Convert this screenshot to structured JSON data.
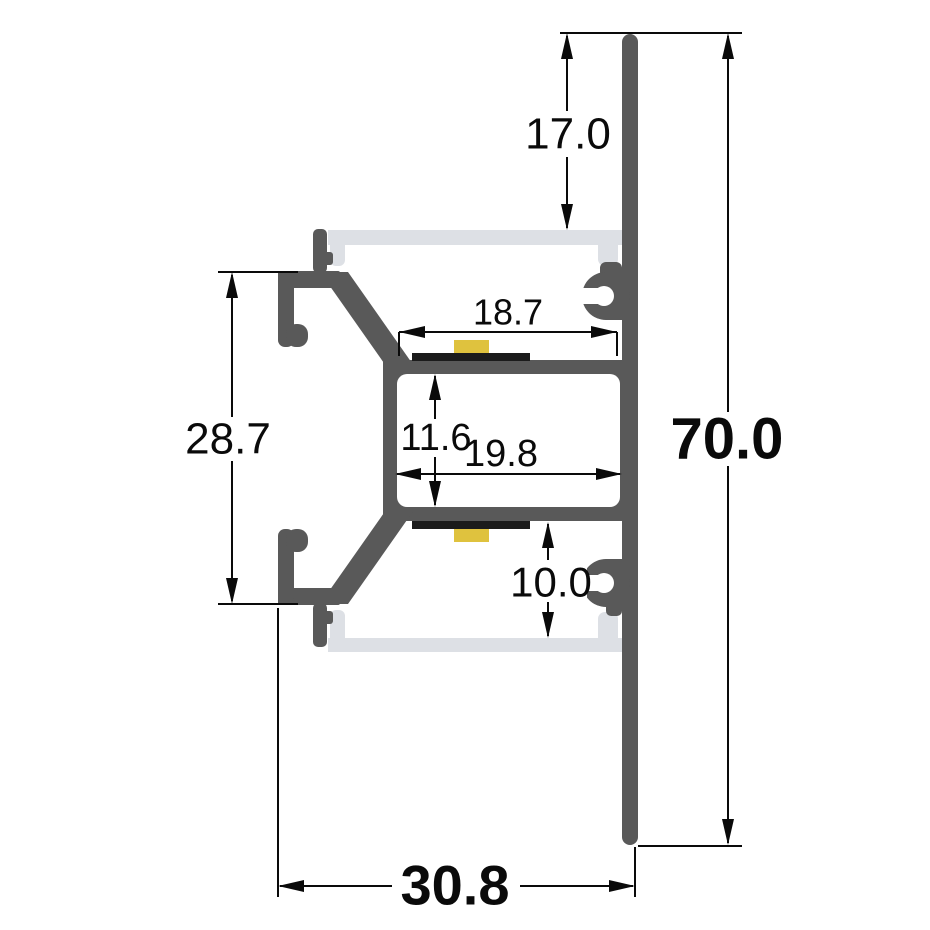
{
  "drawing": {
    "kind": "aluminium-led-profile-cross-section",
    "dimensions": {
      "recess_depth": "17.0",
      "overall_height": "70.0",
      "front_plate_height": "28.7",
      "upper_led_shelf_width": "18.7",
      "cable_channel_height": "11.6",
      "cable_channel_width": "19.8",
      "lower_cavity_height": "10.0",
      "overall_width": "30.8"
    }
  },
  "colors": {
    "profile": "#595959",
    "diffuser": "#dde0e5",
    "pcb": "#1b1b1b",
    "chip": "#dfc23e",
    "dim": "#0a0a0a",
    "bg": "#ffffff"
  }
}
